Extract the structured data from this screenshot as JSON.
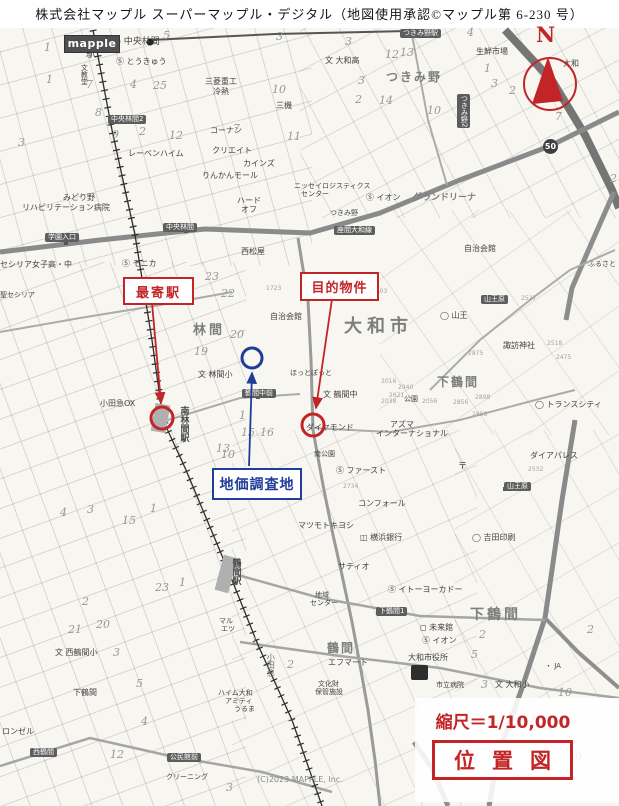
{
  "header": {
    "title": "株式会社マップル スーパーマップル・デジタル（地図使用承認©マップル第 6-230 号）"
  },
  "logo": {
    "text": "mapple"
  },
  "compass": {
    "label": "N"
  },
  "road_badge": {
    "text": "50"
  },
  "copyright": {
    "text": "(C)2023 MAPPLE, Inc."
  },
  "annotations": {
    "nearest_station": {
      "label": "最寄駅"
    },
    "target_property": {
      "label": "目的物件"
    },
    "survey_site": {
      "label": "地価調査地"
    },
    "scale_text": "縮尺＝1/10,000",
    "map_title": "位置図",
    "colors": {
      "red": "#c32527",
      "blue": "#1f3d99"
    }
  },
  "map": {
    "labels": [
      {
        "t": "中央林間",
        "x": 113,
        "y": 38,
        "fs": 9,
        "icon": "●"
      },
      {
        "t": "駅",
        "x": 86,
        "y": 50,
        "fs": 10
      },
      {
        "t": "とうきゅう",
        "x": 116,
        "y": 58,
        "fs": 8,
        "icon": "Ⓢ"
      },
      {
        "t": "文教堂",
        "x": 80,
        "y": 64,
        "fs": 7,
        "vert": true
      },
      {
        "t": "三菱重工",
        "x": 205,
        "y": 78,
        "fs": 8
      },
      {
        "t": "冷熱",
        "x": 213,
        "y": 88,
        "fs": 8
      },
      {
        "t": "三機",
        "x": 276,
        "y": 102,
        "fs": 8
      },
      {
        "t": "中央林間2",
        "x": 108,
        "y": 115,
        "cls": "busstop"
      },
      {
        "t": "コーナン",
        "x": 210,
        "y": 127,
        "fs": 8
      },
      {
        "t": "つきみ野駅",
        "x": 400,
        "y": 29,
        "cls": "busstop"
      },
      {
        "t": "大和高",
        "x": 325,
        "y": 57,
        "fs": 8,
        "icon": "文"
      },
      {
        "t": "つきみ野",
        "x": 386,
        "y": 71,
        "cls": "area",
        "fs": 12,
        "ls": 2
      },
      {
        "t": "生鮮市場",
        "x": 476,
        "y": 48,
        "fs": 8
      },
      {
        "t": "大和",
        "x": 563,
        "y": 60,
        "fs": 8
      },
      {
        "t": "つきみ野2",
        "x": 457,
        "y": 94,
        "cls": "busstop",
        "vert": true
      },
      {
        "t": "レーベンハイム",
        "x": 128,
        "y": 150,
        "fs": 8
      },
      {
        "t": "クリエイト",
        "x": 212,
        "y": 147,
        "fs": 8
      },
      {
        "t": "カインズ",
        "x": 243,
        "y": 160,
        "fs": 8
      },
      {
        "t": "りんかんモール",
        "x": 202,
        "y": 172,
        "fs": 8
      },
      {
        "t": "みどり野",
        "x": 63,
        "y": 194,
        "fs": 8
      },
      {
        "t": "リハビリテーション病院",
        "x": 22,
        "y": 204,
        "fs": 8
      },
      {
        "t": "ハード",
        "x": 237,
        "y": 197,
        "fs": 8
      },
      {
        "t": "オフ",
        "x": 241,
        "y": 206,
        "fs": 8
      },
      {
        "t": "ニッセイロジスティクス",
        "x": 294,
        "y": 183,
        "fs": 7
      },
      {
        "t": "センター",
        "x": 301,
        "y": 191,
        "fs": 7
      },
      {
        "t": "イオン",
        "x": 366,
        "y": 194,
        "fs": 8,
        "icon": "Ⓢ"
      },
      {
        "t": "グランドリーナ",
        "x": 413,
        "y": 194,
        "cls": "area",
        "fs": 9
      },
      {
        "t": "つきみ野",
        "x": 330,
        "y": 210,
        "fs": 7
      },
      {
        "t": "座間大和線",
        "x": 334,
        "y": 226,
        "cls": "busstop"
      },
      {
        "t": "中央林間",
        "x": 163,
        "y": 223,
        "cls": "busstop"
      },
      {
        "t": "学園入口",
        "x": 45,
        "y": 233,
        "cls": "busstop"
      },
      {
        "t": "西松屋",
        "x": 241,
        "y": 248,
        "fs": 8
      },
      {
        "t": "セシリア女子高・中",
        "x": 0,
        "y": 261,
        "fs": 8
      },
      {
        "t": "モニカ",
        "x": 122,
        "y": 260,
        "fs": 8,
        "icon": "Ⓢ"
      },
      {
        "t": "聖セシリア",
        "x": 0,
        "y": 292,
        "fs": 7
      },
      {
        "t": "自治会館",
        "x": 464,
        "y": 245,
        "fs": 8
      },
      {
        "t": "ふるさと",
        "x": 588,
        "y": 261,
        "fs": 7
      },
      {
        "t": "自治会館",
        "x": 270,
        "y": 313,
        "fs": 8
      },
      {
        "t": "大和市",
        "x": 344,
        "y": 318,
        "cls": "area",
        "fs": 18,
        "ls": 5
      },
      {
        "t": "山王",
        "x": 440,
        "y": 312,
        "fs": 8,
        "icon": "◯"
      },
      {
        "t": "山王原",
        "x": 481,
        "y": 295,
        "cls": "busstop"
      },
      {
        "t": "諏訪神社",
        "x": 503,
        "y": 342,
        "fs": 8
      },
      {
        "t": "林間",
        "x": 193,
        "y": 324,
        "cls": "area",
        "fs": 13,
        "ls": 3
      },
      {
        "t": "林間小",
        "x": 198,
        "y": 371,
        "fs": 8,
        "icon": "文"
      },
      {
        "t": "鶴間中前",
        "x": 242,
        "y": 389,
        "cls": "busstop"
      },
      {
        "t": "鶴間中",
        "x": 323,
        "y": 391,
        "fs": 8,
        "icon": "文"
      },
      {
        "t": "ほっとぽっと",
        "x": 290,
        "y": 370,
        "fs": 7
      },
      {
        "t": "小田急OX",
        "x": 100,
        "y": 400,
        "fs": 8
      },
      {
        "t": "南林間駅",
        "x": 178,
        "y": 406,
        "cls": "stationv",
        "vert": true,
        "fs": 9
      },
      {
        "t": "下鶴間",
        "x": 437,
        "y": 376,
        "cls": "area",
        "fs": 12,
        "ls": 2
      },
      {
        "t": "公園",
        "x": 404,
        "y": 396,
        "fs": 7
      },
      {
        "t": "トランスシティ",
        "x": 535,
        "y": 401,
        "fs": 8,
        "icon": "◯"
      },
      {
        "t": "アズマ",
        "x": 390,
        "y": 421,
        "fs": 8
      },
      {
        "t": "インターナショナル",
        "x": 376,
        "y": 430,
        "fs": 8
      },
      {
        "t": "ダイヤモンド",
        "x": 306,
        "y": 424,
        "fs": 8
      },
      {
        "t": "南公園",
        "x": 314,
        "y": 451,
        "fs": 7
      },
      {
        "t": "ファースト",
        "x": 336,
        "y": 467,
        "fs": 8,
        "icon": "Ⓢ"
      },
      {
        "t": "〒",
        "x": 458,
        "y": 463,
        "fs": 9
      },
      {
        "t": "ダイアパレス",
        "x": 530,
        "y": 452,
        "fs": 8
      },
      {
        "t": "コンフォール",
        "x": 358,
        "y": 500,
        "fs": 8
      },
      {
        "t": "山王原",
        "x": 504,
        "y": 482,
        "cls": "busstop"
      },
      {
        "t": "マツモトキヨシ",
        "x": 298,
        "y": 522,
        "fs": 8
      },
      {
        "t": "横浜銀行",
        "x": 360,
        "y": 534,
        "fs": 8,
        "icon": "◫"
      },
      {
        "t": "吉田印刷",
        "x": 472,
        "y": 534,
        "fs": 8,
        "icon": "◯"
      },
      {
        "t": "サティオ",
        "x": 338,
        "y": 563,
        "fs": 8
      },
      {
        "t": "イトーヨーカドー",
        "x": 388,
        "y": 586,
        "fs": 8,
        "icon": "Ⓢ"
      },
      {
        "t": "地域",
        "x": 315,
        "y": 592,
        "fs": 7
      },
      {
        "t": "センター",
        "x": 310,
        "y": 600,
        "fs": 7
      },
      {
        "t": "下鶴間1",
        "x": 376,
        "y": 607,
        "cls": "busstop"
      },
      {
        "t": "未来館",
        "x": 420,
        "y": 624,
        "fs": 8,
        "icon": "◻"
      },
      {
        "t": "イオン",
        "x": 422,
        "y": 637,
        "fs": 8,
        "icon": "Ⓢ"
      },
      {
        "t": "下鶴間",
        "x": 470,
        "y": 608,
        "cls": "area",
        "fs": 14,
        "ls": 3
      },
      {
        "t": "鶴間",
        "x": 327,
        "y": 642,
        "cls": "area",
        "fs": 12,
        "ls": 2
      },
      {
        "t": "エフマート",
        "x": 328,
        "y": 659,
        "fs": 8
      },
      {
        "t": "大和市役所",
        "x": 408,
        "y": 654,
        "fs": 8
      },
      {
        "t": "市立病院",
        "x": 436,
        "y": 682,
        "fs": 7
      },
      {
        "t": "文化財",
        "x": 318,
        "y": 681,
        "fs": 7
      },
      {
        "t": "保管施設",
        "x": 315,
        "y": 689,
        "fs": 7
      },
      {
        "t": "大和小",
        "x": 495,
        "y": 681,
        "fs": 8,
        "icon": "文"
      },
      {
        "t": "JA",
        "x": 545,
        "y": 663,
        "fs": 7,
        "icon": "・"
      },
      {
        "t": "鶴間駅",
        "x": 230,
        "y": 558,
        "cls": "stationv",
        "vert": true,
        "fs": 9
      },
      {
        "t": "マル",
        "x": 219,
        "y": 618,
        "fs": 7
      },
      {
        "t": "エツ",
        "x": 221,
        "y": 626,
        "fs": 7
      },
      {
        "t": "西鶴間小",
        "x": 55,
        "y": 649,
        "fs": 8,
        "icon": "文"
      },
      {
        "t": "小田急",
        "x": 266,
        "y": 653,
        "cls": "railname",
        "vert": true,
        "fs": 8
      },
      {
        "t": "下鶴間",
        "x": 73,
        "y": 689,
        "fs": 8
      },
      {
        "t": "ロンゼル",
        "x": 2,
        "y": 728,
        "fs": 8
      },
      {
        "t": "西鶴間",
        "x": 30,
        "y": 748,
        "cls": "busstop"
      },
      {
        "t": "ハイム大和",
        "x": 218,
        "y": 690,
        "fs": 7
      },
      {
        "t": "アミティ",
        "x": 225,
        "y": 698,
        "fs": 7
      },
      {
        "t": "うるま",
        "x": 234,
        "y": 706,
        "fs": 7
      },
      {
        "t": "公民館前",
        "x": 167,
        "y": 753,
        "cls": "busstop"
      },
      {
        "t": "クリーニング",
        "x": 166,
        "y": 774,
        "fs": 7
      }
    ],
    "block_numbers": [
      [
        "1",
        46,
        74
      ],
      [
        "7",
        86,
        79
      ],
      [
        "4",
        130,
        79
      ],
      [
        "25",
        153,
        80
      ],
      [
        "8",
        95,
        107
      ],
      [
        "9",
        112,
        129
      ],
      [
        "2",
        139,
        126
      ],
      [
        "12",
        169,
        130
      ],
      [
        "3",
        18,
        137
      ],
      [
        "10",
        272,
        84
      ],
      [
        "7",
        233,
        123
      ],
      [
        "11",
        287,
        131
      ],
      [
        "5",
        163,
        30
      ],
      [
        "3",
        276,
        31
      ],
      [
        "1",
        44,
        42
      ],
      [
        "3",
        345,
        36
      ],
      [
        "4",
        467,
        27
      ],
      [
        "13",
        400,
        47
      ],
      [
        "12",
        385,
        49
      ],
      [
        "3",
        358,
        75
      ],
      [
        "2",
        355,
        94
      ],
      [
        "14",
        379,
        95
      ],
      [
        "1",
        484,
        63
      ],
      [
        "3",
        491,
        78
      ],
      [
        "2",
        509,
        85
      ],
      [
        "10",
        427,
        105
      ],
      [
        "7",
        555,
        111
      ],
      [
        "2",
        610,
        173
      ],
      [
        "23",
        205,
        271
      ],
      [
        "22",
        221,
        288
      ],
      [
        "20",
        230,
        329
      ],
      [
        "19",
        194,
        346
      ],
      [
        "1",
        239,
        410
      ],
      [
        "16",
        260,
        427
      ],
      [
        "15",
        241,
        427
      ],
      [
        "13",
        216,
        443
      ],
      [
        "10",
        221,
        449
      ],
      [
        "4",
        60,
        507
      ],
      [
        "3",
        87,
        504
      ],
      [
        "15",
        122,
        515
      ],
      [
        "1",
        150,
        503
      ],
      [
        "2",
        82,
        596
      ],
      [
        "21",
        68,
        624
      ],
      [
        "20",
        96,
        619
      ],
      [
        "3",
        113,
        647
      ],
      [
        "23",
        155,
        582
      ],
      [
        "1",
        179,
        577
      ],
      [
        "5",
        136,
        678
      ],
      [
        "12",
        110,
        749
      ],
      [
        "4",
        141,
        716
      ],
      [
        "2",
        287,
        659
      ],
      [
        "1",
        251,
        636
      ],
      [
        "3",
        226,
        782
      ],
      [
        "2",
        479,
        629
      ],
      [
        "5",
        471,
        649
      ],
      [
        "3",
        481,
        679
      ],
      [
        "2",
        587,
        624
      ],
      [
        "10",
        558,
        687
      ],
      [
        "3",
        528,
        713
      ],
      [
        "7",
        546,
        727
      ],
      [
        "10",
        568,
        751
      ],
      [
        "9",
        508,
        755
      ]
    ],
    "parcel_numbers": [
      [
        "2527",
        521,
        296
      ],
      [
        "2518",
        547,
        341
      ],
      [
        "2475",
        556,
        355
      ],
      [
        "2875",
        468,
        351
      ],
      [
        "3016",
        381,
        379
      ],
      [
        "2940",
        398,
        385
      ],
      [
        "2621",
        389,
        393
      ],
      [
        "2038",
        381,
        399
      ],
      [
        "2056",
        422,
        399
      ],
      [
        "2898",
        475,
        395
      ],
      [
        "2856",
        453,
        400
      ],
      [
        "2858",
        472,
        412
      ],
      [
        "2532",
        528,
        467
      ],
      [
        "2734",
        343,
        484
      ],
      [
        "1723",
        266,
        286
      ],
      [
        "1603",
        372,
        289
      ]
    ]
  }
}
